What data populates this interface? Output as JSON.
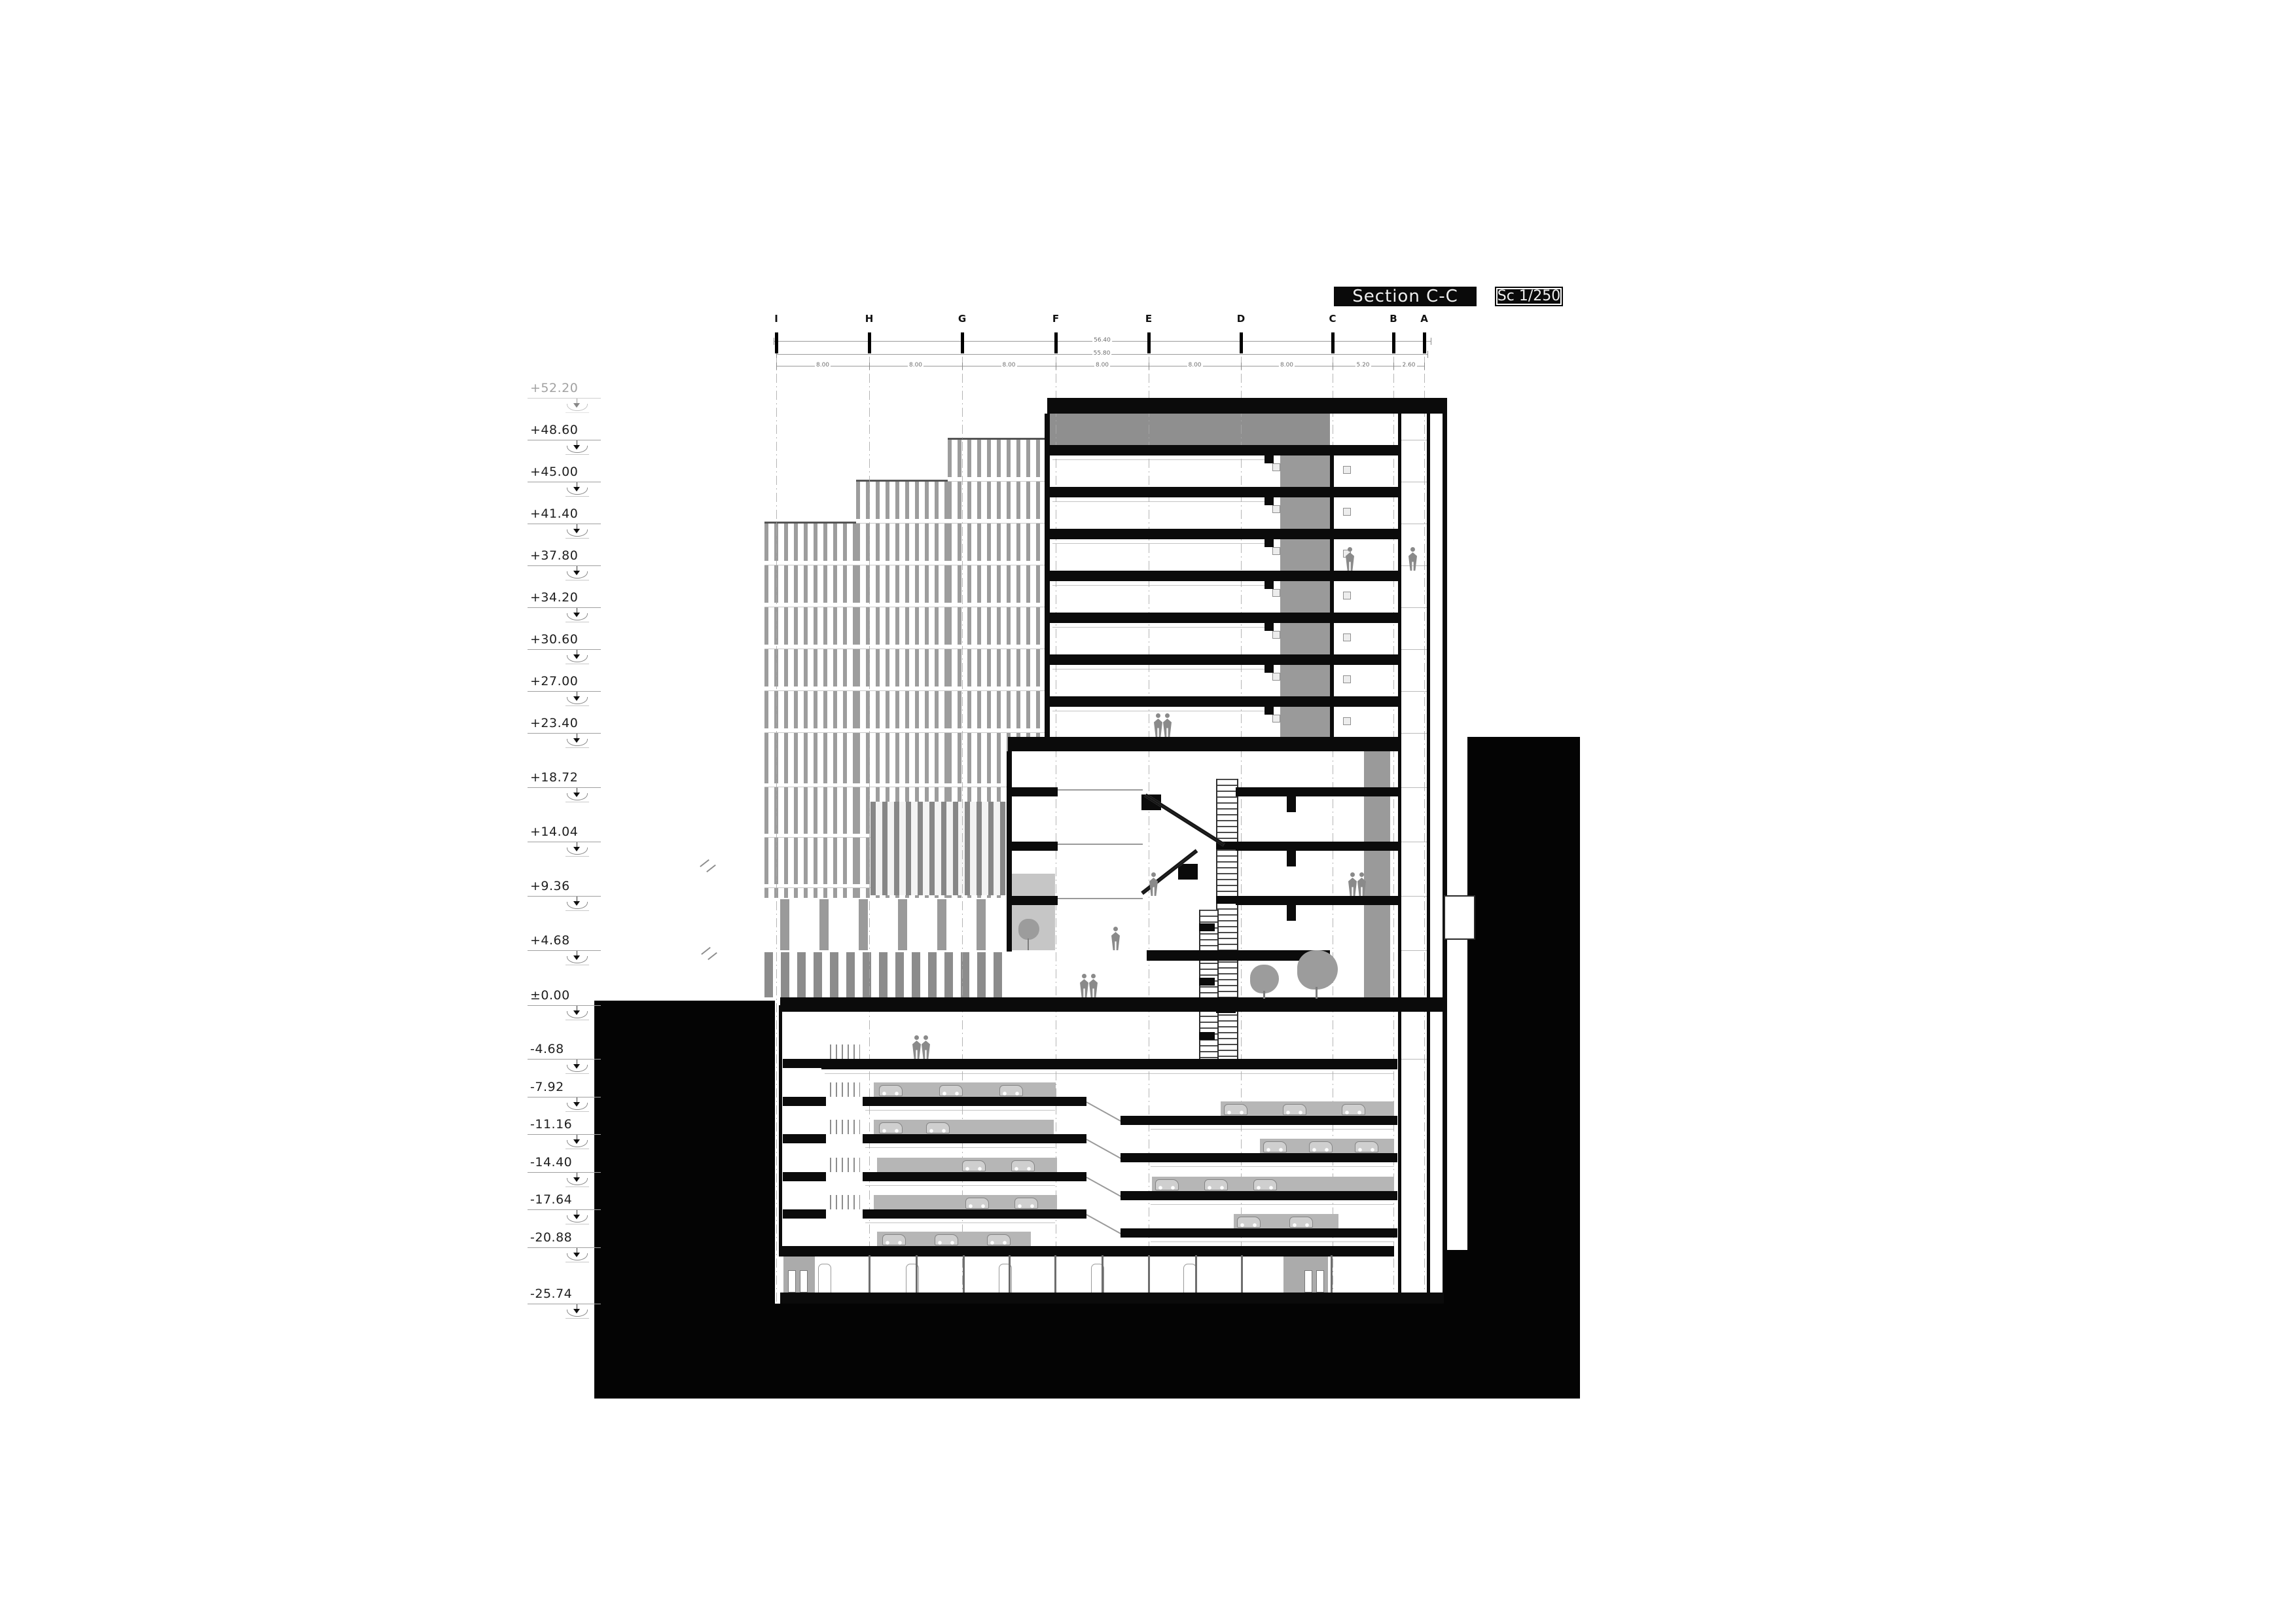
{
  "title": {
    "section_label": "Section C-C",
    "scale_label": "Sc 1/250"
  },
  "grid_letters": [
    "I",
    "H",
    "G",
    "F",
    "E",
    "D",
    "C",
    "B",
    "A"
  ],
  "levels": [
    {
      "label": "+52.20",
      "muted": true
    },
    {
      "label": "+48.60"
    },
    {
      "label": "+45.00"
    },
    {
      "label": "+41.40"
    },
    {
      "label": "+37.80"
    },
    {
      "label": "+34.20"
    },
    {
      "label": "+30.60"
    },
    {
      "label": "+27.00"
    },
    {
      "label": "+23.40"
    },
    {
      "label": "+18.72"
    },
    {
      "label": "+14.04"
    },
    {
      "label": "+9.36"
    },
    {
      "label": "+4.68"
    },
    {
      "label": "±0.00"
    },
    {
      "label": "-4.68"
    },
    {
      "label": "-7.92"
    },
    {
      "label": "-11.16"
    },
    {
      "label": "-14.40"
    },
    {
      "label": "-17.64"
    },
    {
      "label": "-20.88"
    },
    {
      "label": "-25.74"
    }
  ],
  "dimensions": {
    "overall_top": "56.40",
    "overall_mid": "55.80",
    "bay_spans": [
      "8.00",
      "8.00",
      "8.00",
      "8.00",
      "8.00",
      "8.00",
      "5.20",
      "2.60"
    ]
  },
  "colors": {
    "ink": "#0b0b0b",
    "earth": "#040404",
    "stripe_gray": "#9d9d9d",
    "mech_gray": "#8f8f8f",
    "core_gray": "#9a9a9a",
    "light_gray": "#c6c6c6",
    "figure_gray": "#8a8a8a",
    "grid_line_gray": "#a8a8a8"
  }
}
